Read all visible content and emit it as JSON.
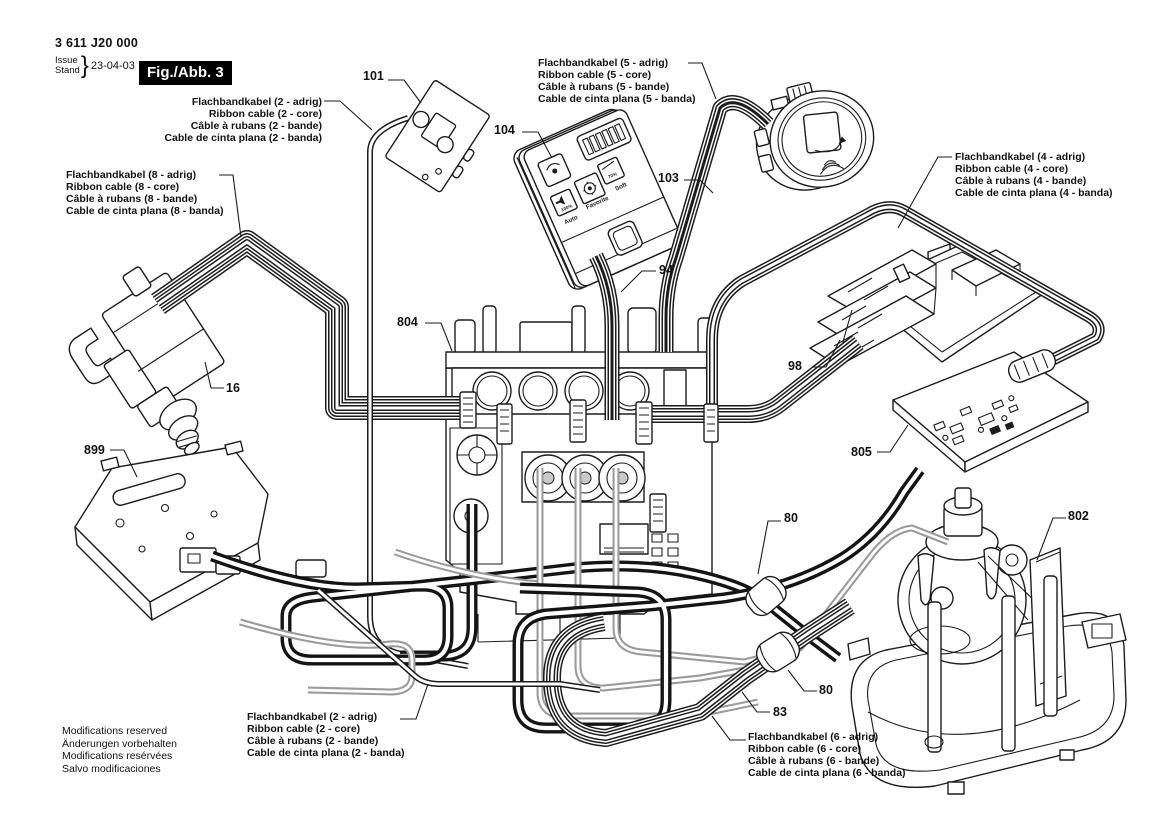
{
  "header": {
    "part_number": "3 611 J20 000",
    "issue_label": "Issue",
    "stand_label": "Stand",
    "brace": "}",
    "date": "23-04-03",
    "figure_label": "Fig./Abb. 3"
  },
  "cable_labels": {
    "c2_top": {
      "de": "Flachbandkabel (2 - adrig)",
      "en": "Ribbon cable (2 - core)",
      "fr": "Câble à rubans (2 - bande)",
      "es": "Cable de cinta plana (2 - banda)"
    },
    "c5": {
      "de": "Flachbandkabel (5 - adrig)",
      "en": "Ribbon cable (5 - core)",
      "fr": "Câble à rubans (5 - bande)",
      "es": "Cable de cinta plana (5 - banda)"
    },
    "c4": {
      "de": "Flachbandkabel (4 - adrig)",
      "en": "Ribbon cable (4 - core)",
      "fr": "Câble à rubans (4 - bande)",
      "es": "Cable de cinta plana (4 - banda)"
    },
    "c8": {
      "de": "Flachbandkabel (8 - adrig)",
      "en": "Ribbon cable (8 - core)",
      "fr": "Câble à rubans (8 - bande)",
      "es": "Cable de cinta plana (8 - banda)"
    },
    "c2_bottom": {
      "de": "Flachbandkabel (2 - adrig)",
      "en": "Ribbon cable (2 - core)",
      "fr": "Câble à rubans (2 - bande)",
      "es": "Cable de cinta plana (2 - banda)"
    },
    "c6": {
      "de": "Flachbandkabel (6 - adrig)",
      "en": "Ribbon cable (6 - core)",
      "fr": "Câble à rubans (6 - bande)",
      "es": "Cable de cinta plana (6 - banda)"
    }
  },
  "callouts": {
    "p101": "101",
    "p104": "104",
    "p103": "103",
    "p94": "94",
    "p804": "804",
    "p16": "16",
    "p98": "98",
    "p805": "805",
    "p899": "899",
    "p80a": "80",
    "p802": "802",
    "p80b": "80",
    "p83": "83"
  },
  "footer": {
    "en": "Modifications reserved",
    "de": "Änderungen vorbehalten",
    "fr": "Modifications resérvées",
    "es": "Salvo modificaciones"
  },
  "remote_panel": {
    "btn_auto": "Auto",
    "btn_favorite": "Favorite",
    "btn_soft": "Soft",
    "pct_100": "100%",
    "pct_70": "70%"
  }
}
